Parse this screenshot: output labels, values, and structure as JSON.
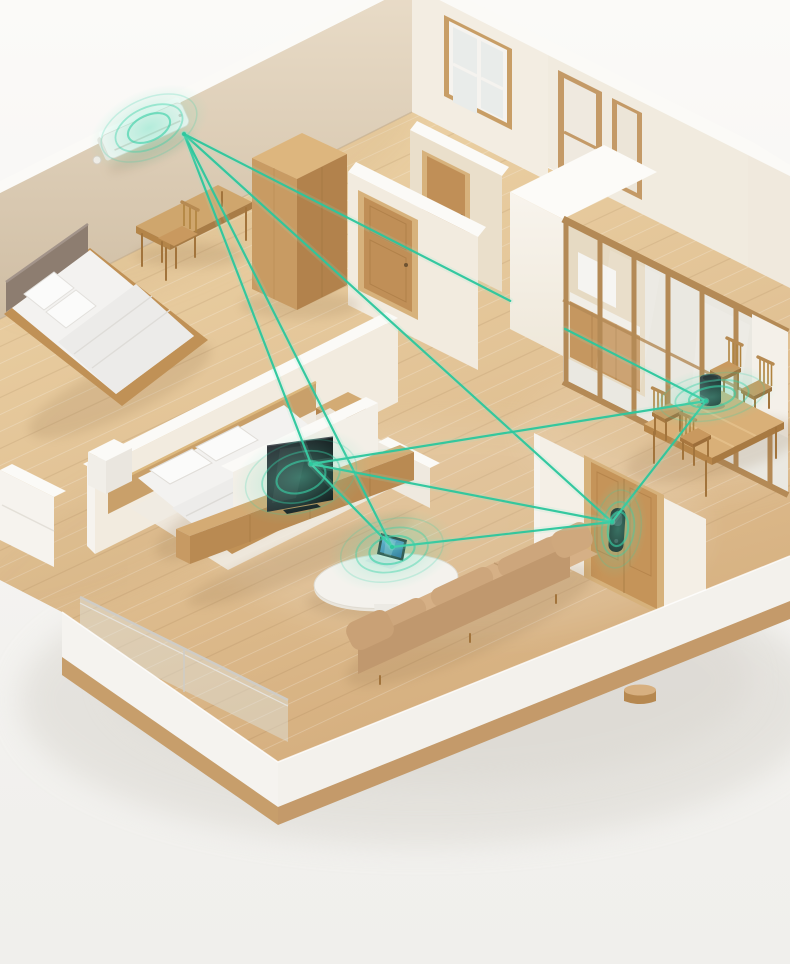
{
  "scene": {
    "type": "smart-home-mesh-network-illustration",
    "background_color": "#f6f5f2",
    "accent_color": "#2cc79d"
  },
  "network": {
    "line_color": "#2cc79d",
    "line_glow_color": "#8fe9cf",
    "ring_color": "#38d1a7",
    "line_width": 2.2,
    "ring_scales": [
      1,
      0.7,
      0.44
    ],
    "ring_widths": [
      1.5,
      1.8,
      2.1
    ],
    "ring_opacities": [
      0.22,
      0.42,
      0.62
    ]
  },
  "devices": [
    {
      "id": "ac",
      "name": "air-conditioner",
      "room": "bedroom",
      "anchor": {
        "x": 184,
        "y": 134
      },
      "rings": {
        "cx": 149,
        "cy": 128,
        "rx": 51,
        "ry": 29,
        "rotate": -25
      }
    },
    {
      "id": "tv",
      "name": "television",
      "room": "living-room",
      "anchor": {
        "x": 311,
        "y": 464
      },
      "rings": {
        "cx": 301,
        "cy": 477,
        "rx": 57,
        "ry": 35,
        "rotate": -17
      }
    },
    {
      "id": "laptop",
      "name": "laptop",
      "room": "living-room",
      "anchor": {
        "x": 392,
        "y": 547
      },
      "rings": {
        "cx": 392,
        "cy": 550,
        "rx": 52,
        "ry": 31,
        "rotate": -12
      }
    },
    {
      "id": "door-lock",
      "name": "smart-door-lock",
      "room": "entry",
      "anchor": {
        "x": 612,
        "y": 522
      },
      "rings": {
        "cx": 618,
        "cy": 529,
        "rx": 23,
        "ry": 39,
        "rotate": 7
      }
    },
    {
      "id": "speaker",
      "name": "smart-speaker",
      "room": "dining-room",
      "anchor": {
        "x": 706,
        "y": 401
      },
      "rings": {
        "cx": 712,
        "cy": 397,
        "rx": 53,
        "ry": 23,
        "rotate": -10
      }
    }
  ],
  "connections": [
    {
      "from": "ac",
      "to": "tv"
    },
    {
      "from": "ac",
      "to": "laptop"
    },
    {
      "from": "ac",
      "to": "door-lock"
    },
    {
      "from": "ac",
      "to": "speaker",
      "gap": [
        0.625,
        0.73
      ]
    },
    {
      "from": "tv",
      "to": "laptop"
    },
    {
      "from": "tv",
      "to": "door-lock"
    },
    {
      "from": "tv",
      "to": "speaker"
    },
    {
      "from": "laptop",
      "to": "door-lock"
    },
    {
      "from": "door-lock",
      "to": "speaker"
    }
  ]
}
